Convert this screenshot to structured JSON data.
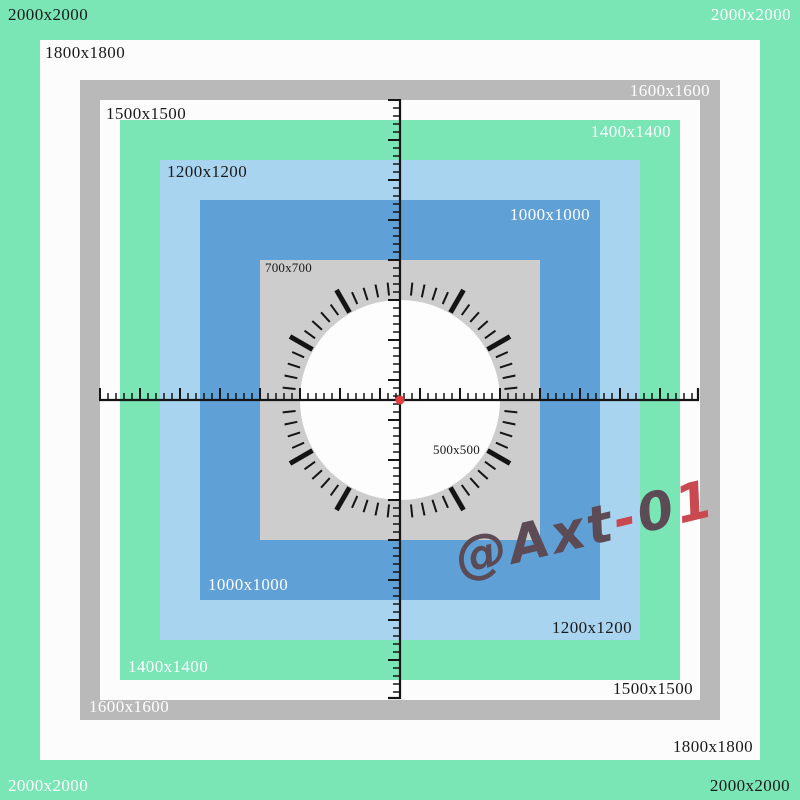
{
  "colors": {
    "bg-green": "#7ae5b5",
    "square-white": "#fcfcfc",
    "frame-gray": "#b9b9b9",
    "inner-gray": "#cdcdcd",
    "light-blue": "#a9d4f0",
    "mid-blue": "#5fa0d7",
    "circle-white": "#fdfdfd",
    "tick-black": "#141414",
    "center-dot-red": "#e23c3c",
    "label-dark": "#1a1a1a",
    "label-light": "#ffffff",
    "watermark-dark": "#5c4a55",
    "watermark-red": "#ca4950"
  },
  "labels": {
    "tl2000": "2000x2000",
    "tr2000": "2000x2000",
    "bl2000": "2000x2000",
    "br2000": "2000x2000",
    "tl1800": "1800x1800",
    "br1800": "1800x1800",
    "tr1600": "1600x1600",
    "bl1600": "1600x1600",
    "tl1500": "1500x1500",
    "br1500": "1500x1500",
    "tr1400": "1400x1400",
    "bl1400": "1400x1400",
    "tl1200": "1200x1200",
    "br1200": "1200x1200",
    "tr1000": "1000x1000",
    "bl1000": "1000x1000",
    "tl700": "700x700",
    "c500": "500x500"
  },
  "watermark": {
    "at": "@Axt",
    "dash": "-",
    "zero": "0",
    "one": "1"
  },
  "figure": {
    "ruler": {
      "center_x": 400,
      "center_y": 400,
      "start": 100,
      "end": 698,
      "minor_step": 8,
      "major_every": 40,
      "minor_len": 7,
      "major_len": 12
    },
    "clock": {
      "cx": 400,
      "cy": 400,
      "minute_ticks": 60,
      "thin_inner": 105,
      "thin_outer": 118,
      "thick_inner": 101,
      "thick_outer": 127,
      "thick_hours": [
        1,
        2,
        4,
        5,
        7,
        8,
        10,
        11
      ]
    },
    "center_dot": {
      "r": 4.5
    }
  }
}
